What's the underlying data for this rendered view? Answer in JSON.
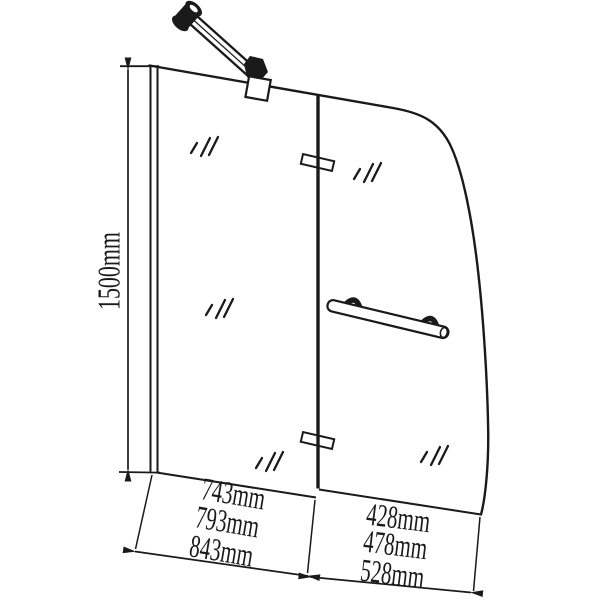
{
  "page": {
    "background": "#ffffff",
    "line_color": "#1a1a1a"
  },
  "diagram": {
    "kind": "bath-shower-screen-dimension-drawing",
    "height_dimension": {
      "label": "1500mm"
    },
    "left_panel_width_dimensions": {
      "labels": [
        "743mm",
        "793mm",
        "843mm"
      ]
    },
    "right_panel_width_dimensions": {
      "labels": [
        "428mm",
        "478mm",
        "528mm"
      ]
    }
  }
}
